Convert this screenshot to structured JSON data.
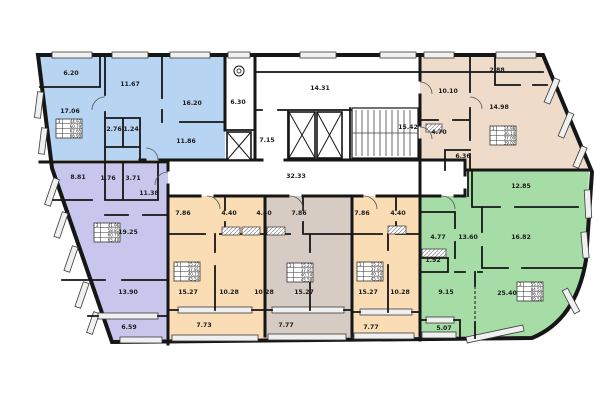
{
  "colors": {
    "apt_blue": "#b7d4f2",
    "apt_purple": "#c9c6ee",
    "apt_peach": "#fadcb5",
    "apt_taupe": "#d7ccc4",
    "apt_beige": "#eedbc9",
    "apt_green": "#a6dca6",
    "wall": "#161616",
    "window_fill": "#f0f0f0"
  },
  "common": {
    "upper_corridor": "14.31",
    "main_corridor": "32.33",
    "lobby": "7.15",
    "trash_room": "6.30",
    "stairs": "15.42"
  },
  "apartments": [
    {
      "id": "blue-3-room",
      "rooms": {
        "balcony": "6.20",
        "living": "17.06",
        "bedroom1": "11.67",
        "bedroom2": "16.20",
        "bath": "2.76",
        "wc": "1.24",
        "hall": "11.86"
      },
      "summary": {
        "rooms": "3",
        "r1": "44.93",
        "r2": "60.79",
        "r3": "62.65",
        "r4": "66.99"
      }
    },
    {
      "id": "purple-3-room",
      "rooms": {
        "bedroom1": "8.81",
        "wc": "1.76",
        "bath": "3.71",
        "hall": "11.38",
        "living": "19.25",
        "bedroom2": "13.90",
        "balcony": "6.59"
      },
      "summary": {
        "rooms": "3",
        "r1": "41.96",
        "r2": "58.81",
        "r3": "60.79",
        "r4": "65.40"
      }
    },
    {
      "id": "peach-1-room-a",
      "rooms": {
        "hall": "7.86",
        "bath": "4.40",
        "living": "15.27",
        "kitchen": "10.28",
        "balcony": "7.73"
      },
      "summary": {
        "rooms": "1",
        "r1": "15.27",
        "r2": "37.81",
        "r3": "40.13",
        "r4": "45.54"
      }
    },
    {
      "id": "taupe-1-room",
      "rooms": {
        "bath": "4.40",
        "hall": "7.86",
        "kitchen": "10.28",
        "living": "15.27",
        "balcony": "7.77"
      },
      "summary": {
        "rooms": "1",
        "r1": "15.27",
        "r2": "37.81",
        "r3": "40.14",
        "r4": "45.58"
      }
    },
    {
      "id": "peach-1-room-b",
      "rooms": {
        "hall": "7.86",
        "bath": "4.40",
        "living": "15.27",
        "kitchen": "10.28",
        "balcony": "7.77"
      },
      "summary": {
        "rooms": "1",
        "r1": "15.27",
        "r2": "37.81",
        "r3": "40.14",
        "r4": "45.58"
      }
    },
    {
      "id": "beige-1-room",
      "rooms": {
        "bedroom": "10.10",
        "balcony": "2.88",
        "living": "14.98",
        "kitchen": "4.70",
        "hall": "6.36"
      },
      "summary": {
        "rooms": "1",
        "r1": "14.98",
        "r2": "36.14",
        "r3": "37.00",
        "r4": "39.02"
      }
    },
    {
      "id": "green-3-room",
      "rooms": {
        "bedroom1": "12.85",
        "kitchen": "4.77",
        "hall": "13.60",
        "bedroom2": "16.82",
        "closet": "1.92",
        "corridor": "9.15",
        "living": "25.40",
        "balcony": "5.07"
      },
      "summary": {
        "rooms": "3",
        "r1": "55.07",
        "r2": "84.51",
        "r3": "86.03",
        "r4": "89.58"
      }
    }
  ]
}
